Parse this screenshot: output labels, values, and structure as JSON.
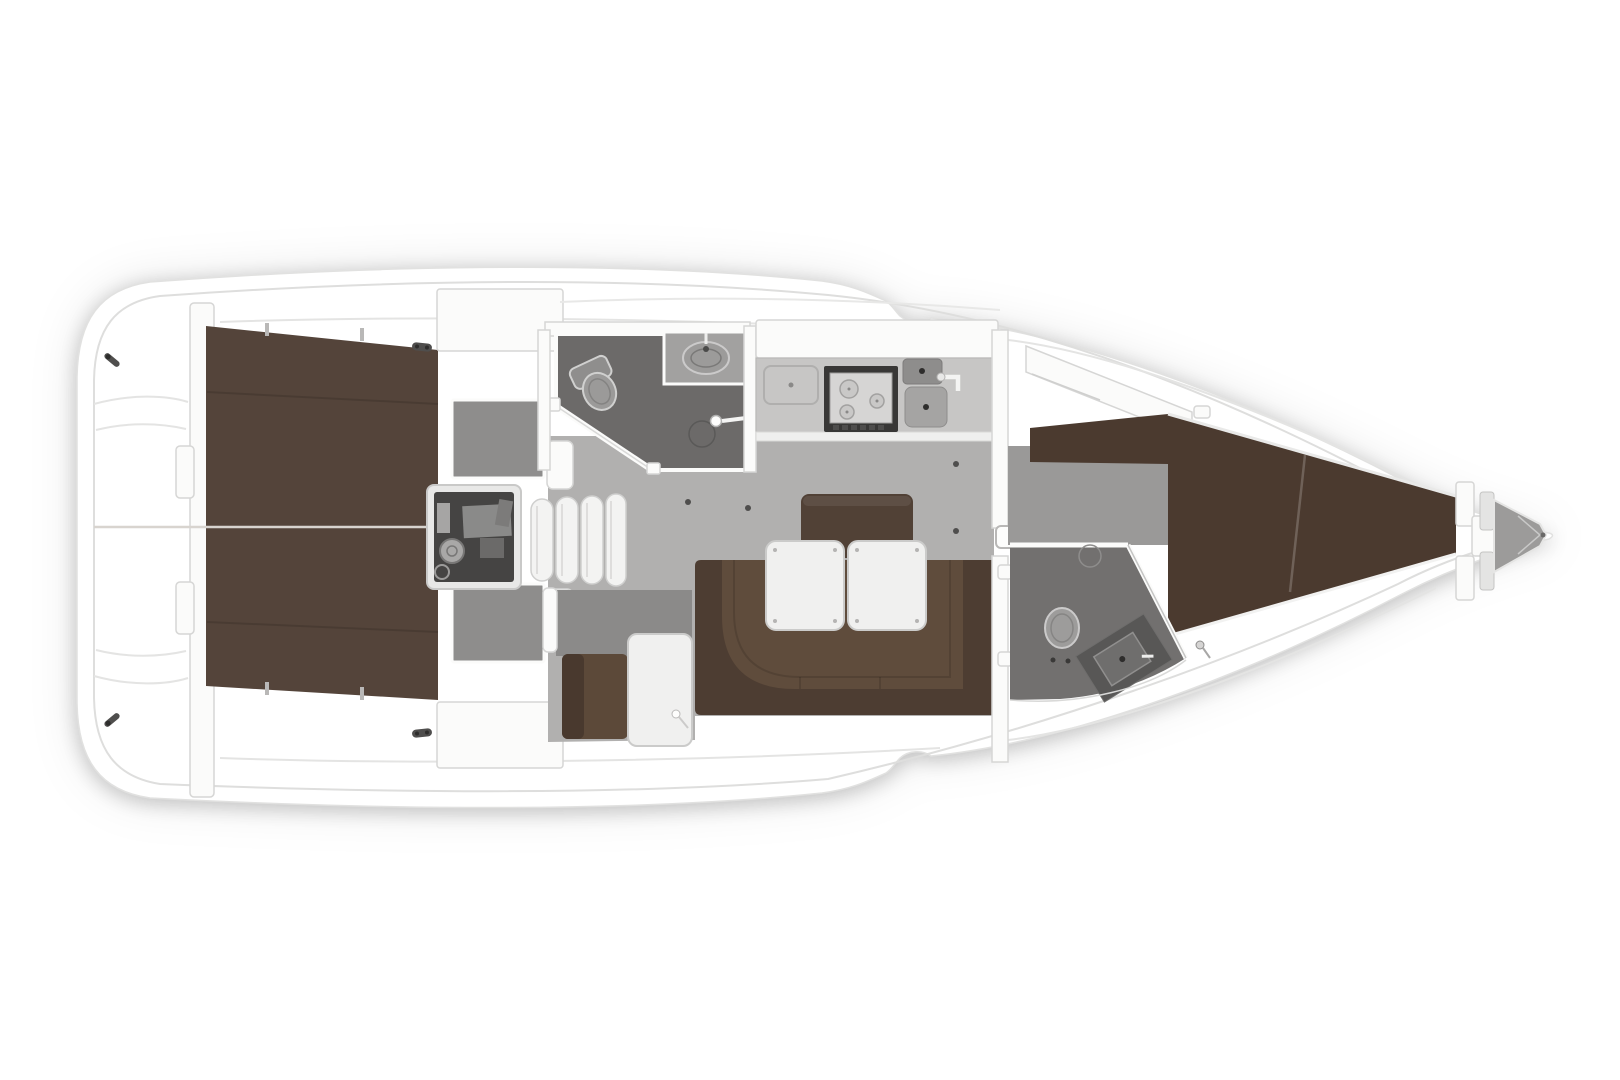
{
  "meta": {
    "title": "Sailing yacht interior floor plan (top-down rendered deck layout, no text labels)",
    "view": "plan view, bow pointing right, stern at left"
  },
  "canvas": {
    "width": 1620,
    "height": 1080,
    "page_bg": "#ffffff"
  },
  "colors": {
    "page_bg": "#ffffff",
    "hull_fill": "#ffffff",
    "hull_stroke": "#e1e1e0",
    "inner_line": "#dededd",
    "deck_line": "#e4e4e3",
    "wall_white": "#fbfbfa",
    "wall_stroke": "#d6d6d5",
    "floor_salon": "#b1b0af",
    "floor_fwd": "#9a9998",
    "floor_head": "#6c6a69",
    "floor_head_fwd": "#72706f",
    "berth_aft": "#54443a",
    "berth_fwd": "#4b3a2f",
    "berth_seam": "rgba(0,0,0,0.12)",
    "settee_back": "#4d3d32",
    "settee_seat": "#5f4c3c",
    "backrest": "#514136",
    "nav_seat": "#5c4939",
    "nav_seat_dark": "#49392e",
    "nav_wall": "#8b8a89",
    "counter": "#c7c6c5",
    "counter_edge": "#efefee",
    "stove_frame": "#383736",
    "stove_panel": "#d6d5d4",
    "sink_dark": "#8e8d8c",
    "sink_light": "#a5a4a3",
    "engine_frame": "#e8e8e7",
    "engine_dark": "#454443",
    "machinery": "#8a8a89",
    "tread_fill": "#f3f3f2",
    "tread_stroke": "#cfcfce",
    "table_fill": "#f0f0ef",
    "table_stroke": "#cbcbca",
    "fixture": "#9c9b9a",
    "fixture_stroke": "#cbcaca",
    "gray_patch": "#8e8d8c",
    "anchor_gray": "#9c9b9a",
    "hardware_dark": "#4f4e4d",
    "centerline": "#d8d4cf"
  },
  "areas": [
    {
      "id": "stern-swim-platform",
      "name": "Stern / swim platform and transom"
    },
    {
      "id": "aft-berth-cabin",
      "name": "Aft double berth (brown mattress, split by centerline)"
    },
    {
      "id": "engine-compartment",
      "name": "Engine compartment under companionway"
    },
    {
      "id": "companionway-steps",
      "name": "Companionway steps (4 curved treads)"
    },
    {
      "id": "aft-head",
      "name": "Aft head: toilet, oval sink, shower with angled door"
    },
    {
      "id": "galley",
      "name": "Galley: counter, 3-burner stove, double sink, faucet"
    },
    {
      "id": "salon",
      "name": "Salon with gray floor and lift-ring dots"
    },
    {
      "id": "u-settee",
      "name": "U-shaped brown settee with backrest block"
    },
    {
      "id": "salon-tables",
      "name": "Two white folding salon tables"
    },
    {
      "id": "nav-seat",
      "name": "Navigation seat (brown) with white chart table"
    },
    {
      "id": "main-bulkhead",
      "name": "Main bulkhead with door latch and hinges"
    },
    {
      "id": "forward-cabin",
      "name": "Forward cabin V-berth (dark brown, tapering to bow)"
    },
    {
      "id": "forward-head",
      "name": "Forward head: toilet, angled vanity, shower ring"
    },
    {
      "id": "anchor-locker",
      "name": "Anchor locker at bow tip"
    }
  ]
}
